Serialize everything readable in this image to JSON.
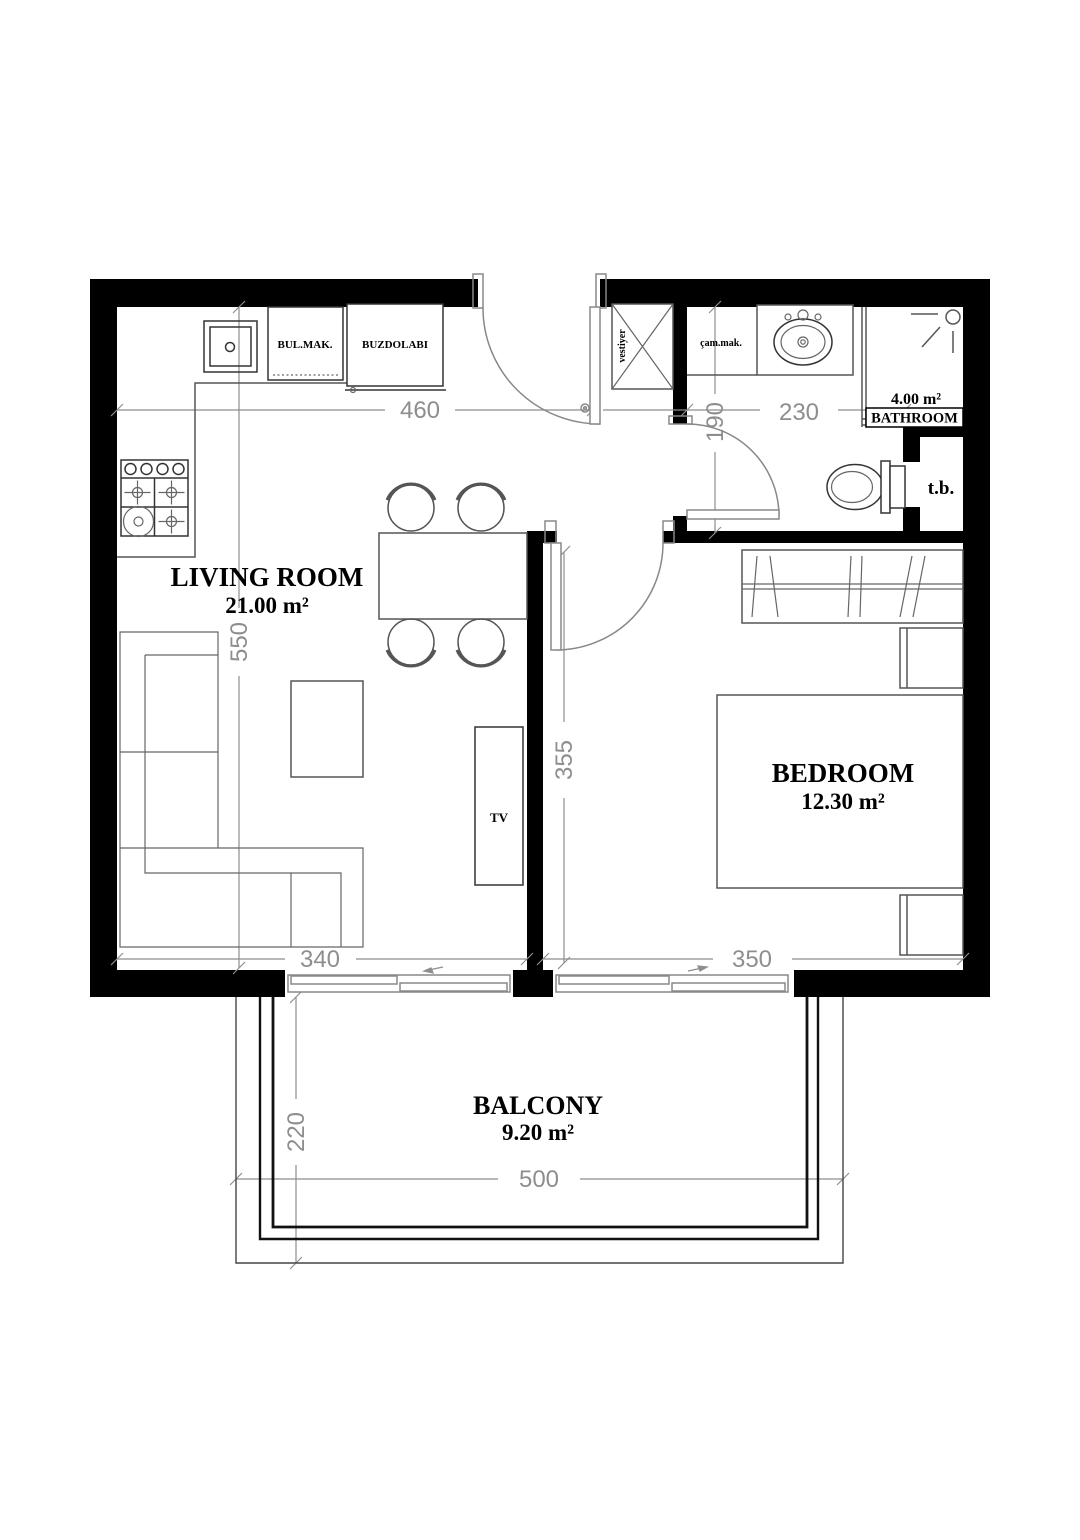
{
  "rooms": {
    "living": {
      "name": "LIVING ROOM",
      "area": "21.00 m²"
    },
    "bedroom": {
      "name": "BEDROOM",
      "area": "12.30 m²"
    },
    "bathroom": {
      "name": "BATHROOM",
      "area": "4.00 m²"
    },
    "balcony": {
      "name": "BALCONY",
      "area": "9.20 m²"
    }
  },
  "fixtures": {
    "dishwasher": "BUL.MAK.",
    "refrigerator": "BUZDOLABI",
    "coat_closet": "vestiyer",
    "washing_machine": "çam.mak.",
    "tv": "TV",
    "technical_box": "t.b."
  },
  "dimensions": {
    "kitchen_wall": "460",
    "bathroom_width": "230",
    "hall_depth": "190",
    "living_length": "550",
    "bedroom_length": "355",
    "living_bottom_width": "340",
    "bedroom_width": "350",
    "balcony_depth": "220",
    "balcony_width": "500"
  },
  "colors": {
    "wall": "#000000",
    "dimension": "#8e8e8e",
    "furniture": "#555555",
    "background": "#ffffff"
  }
}
